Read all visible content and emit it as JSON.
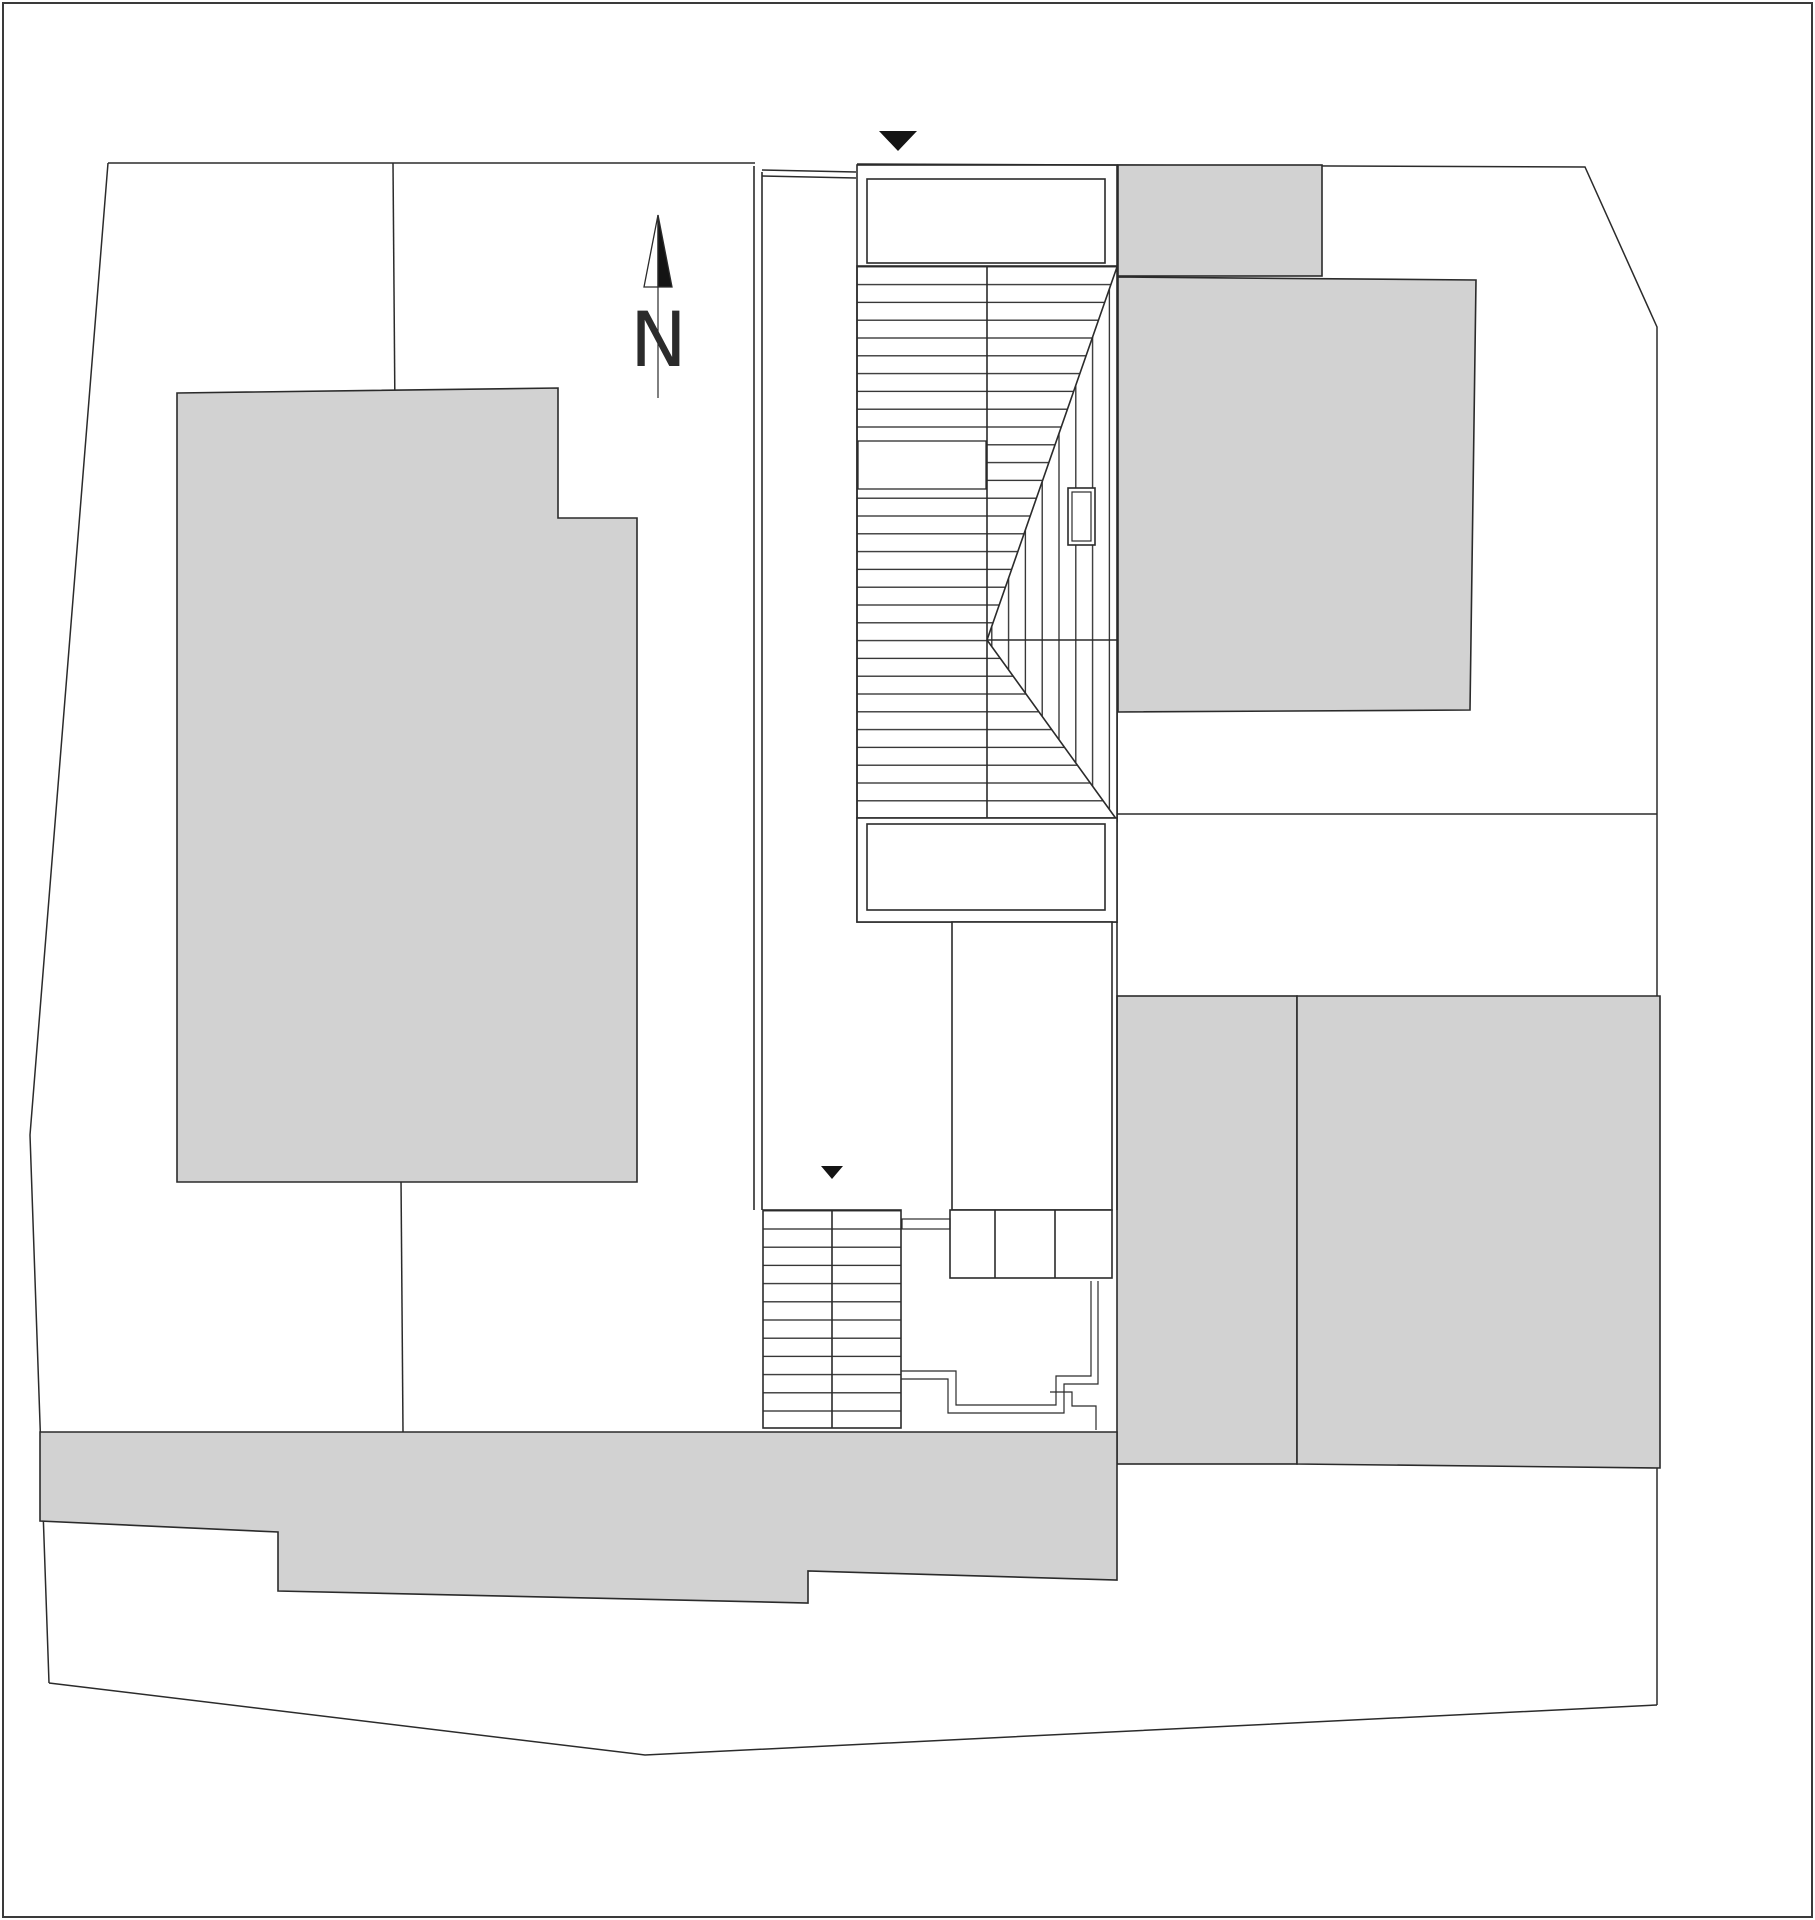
{
  "colors": {
    "background": "#ffffff",
    "line": "#2b2b2b",
    "building_fill": "#d2d2d2",
    "marker_fill": "#141414",
    "sheet_border": "#3a3a3a"
  },
  "north_arrow": {
    "label": "N",
    "icon": "north-arrow-icon"
  },
  "markers": {
    "top_entry_icon": "triangle-down-icon",
    "mid_entry_icon": "triangle-down-icon"
  }
}
